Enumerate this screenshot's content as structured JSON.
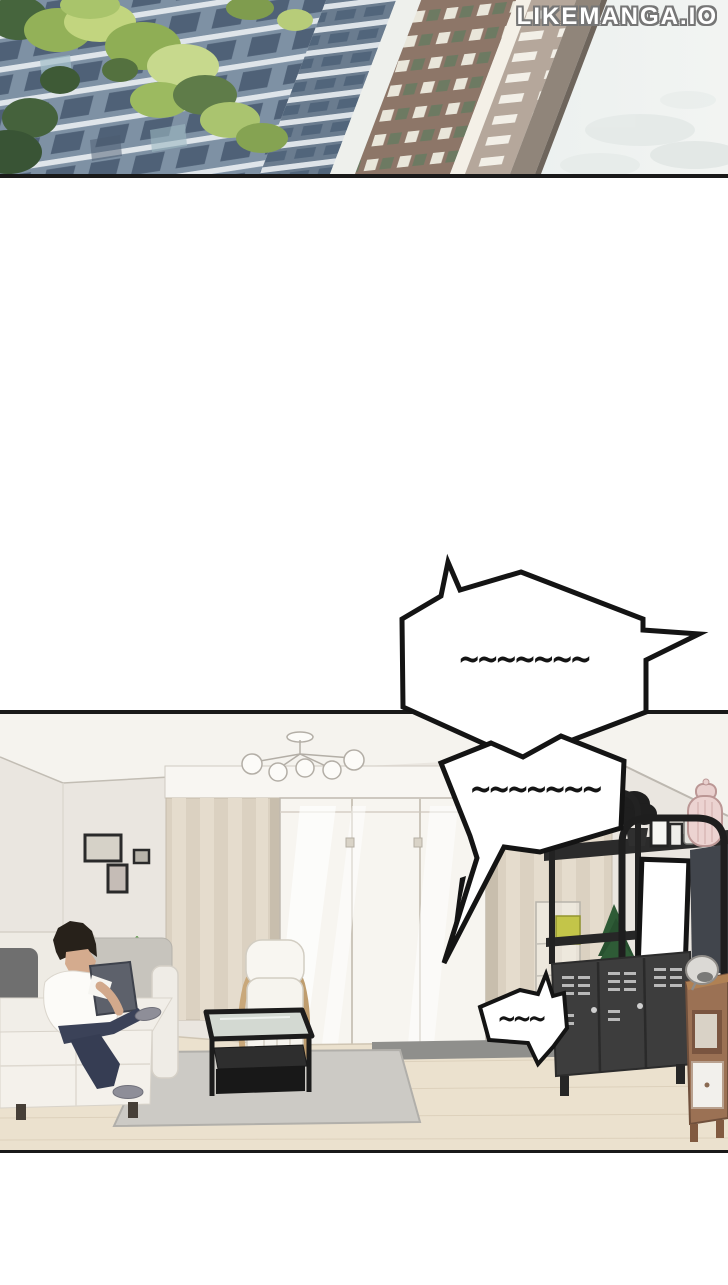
{
  "page": {
    "width": 728,
    "height": 1285,
    "background": "#ffffff"
  },
  "watermark": {
    "text": "LIKEMANGA.IO"
  },
  "panels": [
    {
      "id": "exterior",
      "scene": "high-rise apartment buildings with trees under a pale sky"
    },
    {
      "id": "living-room",
      "scene": "man in white t-shirt sitting on a beige sofa; armchair, glass coffee table on grey rug, sliding glass door with beige curtains, black media shelf with TV, locker cabinet and wooden cabinet"
    }
  ],
  "speech_bubbles": [
    {
      "text": "~~~~~~~"
    },
    {
      "text": "~~~~~~~"
    },
    {
      "text": "~~~"
    }
  ],
  "colors": {
    "panel_border": "#191919",
    "bubble_fill": "#ffffff",
    "bubble_outline": "#141414",
    "watermark_fill": "#ffffff",
    "watermark_outline": "#767676",
    "sky": "#e9efee",
    "foliage": "#9db95e",
    "building_facade": "#7e91a4",
    "brick_building": "#8d7668",
    "wall": "#eae6e0",
    "floor": "#ebe1ce",
    "curtain": "#dbd1c1",
    "rug": "#cccac5",
    "sofa": "#f1eee8",
    "pants": "#3b4258",
    "shelf": "#2b2b2b",
    "locker": "#3d3d3d",
    "cabinet_wood": "#9b7154",
    "lantern_pink": "#ecd3d1"
  }
}
